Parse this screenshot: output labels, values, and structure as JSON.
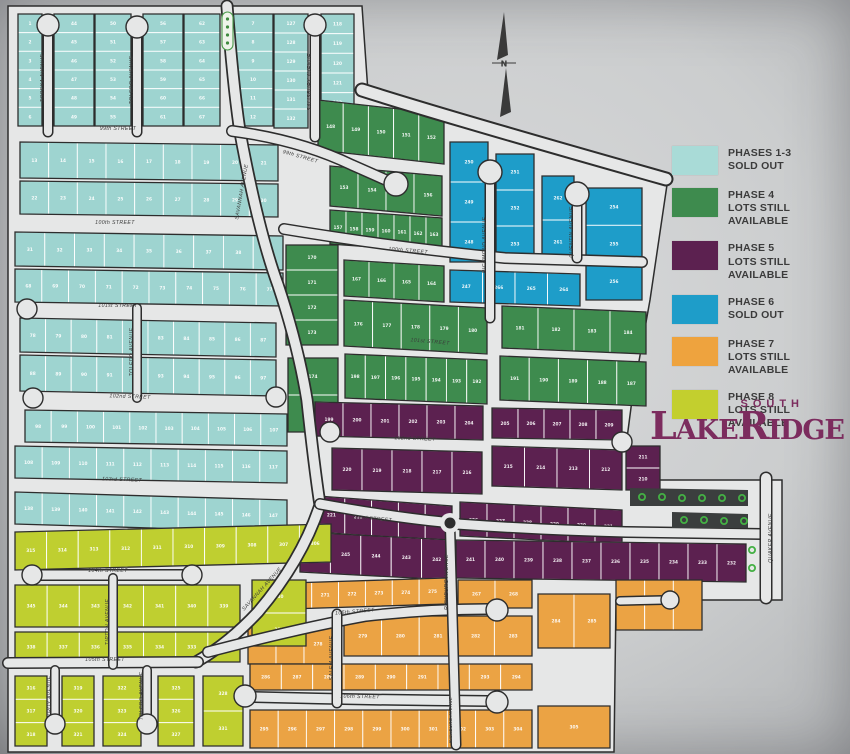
{
  "legend": {
    "items": [
      {
        "phase": "PHASES 1-3",
        "status": "SOLD OUT",
        "color": "#a9dbd7"
      },
      {
        "phase": "PHASE 4",
        "status": "LOTS STILL AVAILABLE",
        "color": "#3e8b4e"
      },
      {
        "phase": "PHASE 5",
        "status": "LOTS STILL AVAILABLE",
        "color": "#5c2150"
      },
      {
        "phase": "PHASE 6",
        "status": "SOLD OUT",
        "color": "#1e9dc9"
      },
      {
        "phase": "PHASE 7",
        "status": "LOTS STILL AVAILABLE",
        "color": "#eea33e"
      },
      {
        "phase": "PHASE 8",
        "status": "LOTS STILL AVAILABLE",
        "color": "#c3cf2e"
      }
    ]
  },
  "logo": {
    "top": "SOUTH",
    "main": "LakeRidge",
    "color": "#7c2c5e"
  },
  "compass": {
    "label": "N"
  },
  "phase_colors": {
    "p13": "#9ed4d0",
    "p4": "#3e8b4e",
    "p5": "#5c2150",
    "p6": "#1e9dc9",
    "p7": "#eba344",
    "p8": "#bfcf30"
  },
  "streets": {
    "s99": "99th STREET",
    "s100": "100th STREET",
    "s101": "101st STREET",
    "s102": "102nd STREET",
    "s103": "103rd STREET",
    "s104": "104th STREET",
    "s105": "105th STREET",
    "s106": "106th STREET",
    "topeka": "TOPEKA AVENUE",
    "toledo": "TOLEDO AVENUE",
    "salisbury": "SALISBURY AVENUE",
    "savannah": "SAVANNAH AVENUE",
    "richmond": "RICHMOND AVENUE",
    "quentin": "QUENTIN AVENUE",
    "richburg": "RICHBURG AVENUE",
    "quaker": "QUAKER AVENUE",
    "salem": "SALEM AVENUE",
    "tipton": "TIPTON AVENUE",
    "troy": "TROY AVENUE"
  },
  "lots": {
    "tA": [
      1,
      2,
      3,
      4,
      5,
      6
    ],
    "tB": [
      44,
      45,
      46,
      47,
      48,
      49
    ],
    "tC": [
      50,
      51,
      52,
      53,
      54,
      55
    ],
    "tD": [
      56,
      57,
      58,
      59,
      60,
      61
    ],
    "tE": [
      62,
      63,
      64,
      65,
      66,
      67
    ],
    "tF": [
      7,
      8,
      9,
      10,
      11,
      12
    ],
    "tG": [
      127,
      128,
      129,
      130,
      131,
      132
    ],
    "tH": [
      118,
      119,
      120,
      121,
      122,
      123
    ],
    "rowA": [
      13,
      14,
      15,
      16,
      17,
      18,
      19,
      20,
      21
    ],
    "rowB": [
      22,
      23,
      24,
      25,
      26,
      27,
      28,
      29,
      30
    ],
    "rowC": [
      31,
      32,
      33,
      34,
      35,
      36,
      37,
      38,
      39
    ],
    "rowD": [
      68,
      69,
      70,
      71,
      72,
      73,
      74,
      75,
      76,
      77
    ],
    "rowE": [
      78,
      79,
      80,
      81,
      82,
      83,
      84,
      85,
      86,
      87
    ],
    "rowF": [
      88,
      89,
      90,
      91,
      92,
      93,
      94,
      95,
      96,
      97
    ],
    "rowG": [
      98,
      99,
      100,
      101,
      102,
      103,
      104,
      105,
      106,
      107
    ],
    "rowH": [
      108,
      109,
      110,
      111,
      112,
      113,
      114,
      115,
      116,
      117
    ],
    "rowI": [
      138,
      139,
      140,
      141,
      142,
      143,
      144,
      145,
      146,
      147
    ],
    "gTop": [
      148,
      149,
      150,
      151,
      152
    ],
    "gFan1": [
      153,
      154,
      155,
      156
    ],
    "gFan2": [
      157,
      158,
      159,
      160,
      161,
      162,
      163
    ],
    "gMid": [
      167,
      166,
      165,
      164
    ],
    "gColSav": [
      170,
      171,
      172,
      173
    ],
    "gColSav2": [
      174,
      175
    ],
    "gRowA": [
      176,
      177,
      178,
      179,
      180
    ],
    "gRowB": [
      181,
      182,
      183,
      184
    ],
    "gRowC": [
      198,
      197,
      196,
      195,
      194,
      193,
      192
    ],
    "gRowD": [
      191,
      190,
      189,
      188,
      187
    ],
    "bRichL": [
      250,
      249,
      248
    ],
    "bRichR": [
      251,
      252,
      253
    ],
    "bBot": [
      247,
      266,
      265,
      264
    ],
    "bQuenL": [
      262,
      261
    ],
    "bQuenR": [
      254,
      255,
      256
    ],
    "p1a": [
      199,
      200,
      201,
      202,
      203,
      204
    ],
    "p1b": [
      205,
      206,
      207,
      208,
      209
    ],
    "pColE": [
      211,
      210
    ],
    "p2a": [
      220,
      219,
      218,
      217,
      216
    ],
    "p2b": [
      215,
      214,
      213,
      212
    ],
    "p3a": [
      221,
      222,
      223,
      224,
      225
    ],
    "p3b": [
      226,
      227,
      228,
      229,
      230,
      231
    ],
    "p4a": [
      246,
      245,
      244,
      243,
      242
    ],
    "p4b": [
      241,
      240,
      239,
      238,
      237,
      236,
      235,
      234,
      233,
      232
    ],
    "oa": [
      269,
      270,
      271,
      272,
      273,
      274,
      275
    ],
    "ob": [
      267,
      268
    ],
    "oc": [
      276,
      277,
      278
    ],
    "od": [
      279,
      280,
      281,
      282,
      283
    ],
    "obulb": [
      284,
      285
    ],
    "of": [
      286,
      287,
      288,
      289,
      290,
      291,
      292,
      293,
      294
    ],
    "og": [
      295,
      296,
      297,
      298,
      299,
      300,
      301,
      302,
      303,
      304
    ],
    "oh": [
      305
    ],
    "ofan": [
      "",
      "",
      ""
    ],
    "y1": [
      315,
      314,
      313,
      312,
      311,
      310,
      309,
      308,
      307,
      306
    ],
    "y2": [
      345,
      344,
      343,
      342,
      341,
      340,
      339
    ],
    "y3": [
      338,
      337,
      336,
      335,
      334,
      333,
      332
    ],
    "yD": [
      330,
      329
    ],
    "y4a": [
      316,
      317,
      318
    ],
    "y4b": [
      319,
      320,
      321
    ],
    "y4c": [
      322,
      323,
      324
    ],
    "y4d": [
      325,
      326,
      327
    ],
    "y4e": [
      328,
      331
    ]
  }
}
